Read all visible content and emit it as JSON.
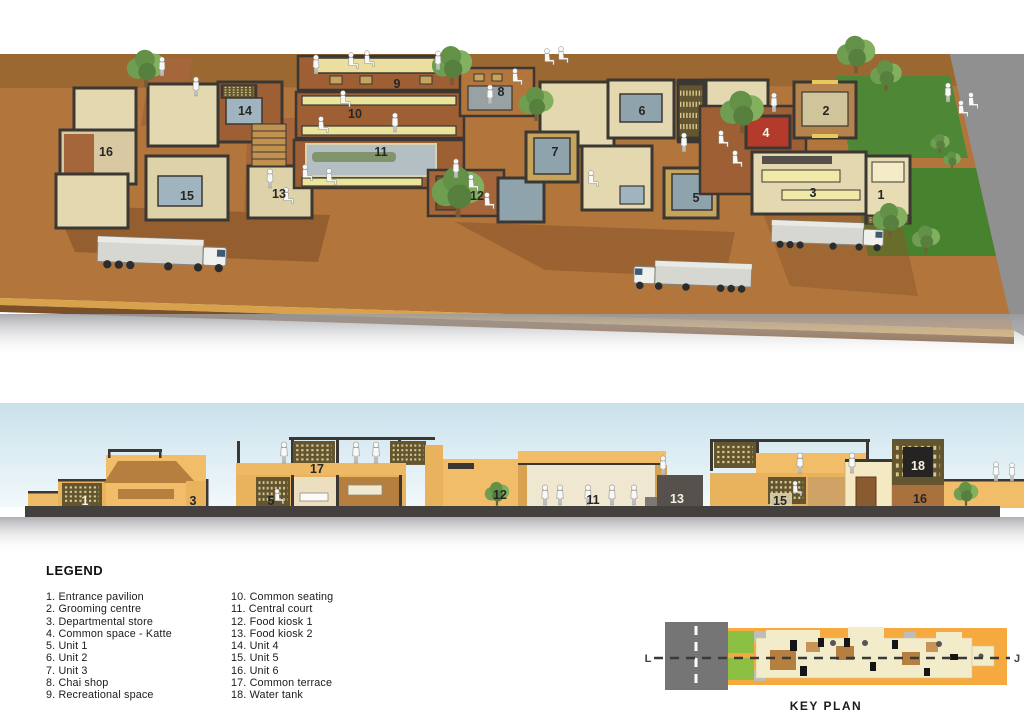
{
  "legend": {
    "title": "LEGEND",
    "items": [
      "1. Entrance pavilion",
      "2. Grooming centre",
      "3. Departmental store",
      "4. Common space - Katte",
      "5. Unit 1",
      "6. Unit 2",
      "7. Unit 3",
      "8. Chai shop",
      "9. Recreational space",
      "10. Common seating",
      "11. Central court",
      "12. Food kiosk 1",
      "13. Food kiosk 2",
      "14. Unit 4",
      "15. Unit 5",
      "16. Unit 6",
      "17. Common terrace",
      "18. Water tank"
    ]
  },
  "axonometric": {
    "markers": [
      "1",
      "2",
      "3",
      "4",
      "5",
      "6",
      "7",
      "8",
      "9",
      "10",
      "11",
      "12",
      "13",
      "14",
      "15",
      "16"
    ]
  },
  "section": {
    "markers": [
      "1",
      "3",
      "5",
      "17",
      "12",
      "11",
      "13",
      "15",
      "18",
      "16"
    ]
  },
  "key_plan": {
    "caption": "KEY PLAN",
    "section_label_left": "L",
    "section_label_right": "J"
  },
  "palette": {
    "ground_brown": "#b2763c",
    "lane_brown": "#9b6831",
    "brick": "#9d5f33",
    "floor_cream": "#e3d8b0",
    "bench_yellow": "#ebe49d",
    "water_gray_blue": "#b3bfc2",
    "accent_red": "#b43a2c",
    "grass_green": "#4e8836",
    "road_gray": "#909090",
    "sky_blue": "#c9e1ec",
    "keyplan_orange": "#f6a93e",
    "keyplan_green": "#8cc043",
    "wall_dark": "#3b3733"
  }
}
